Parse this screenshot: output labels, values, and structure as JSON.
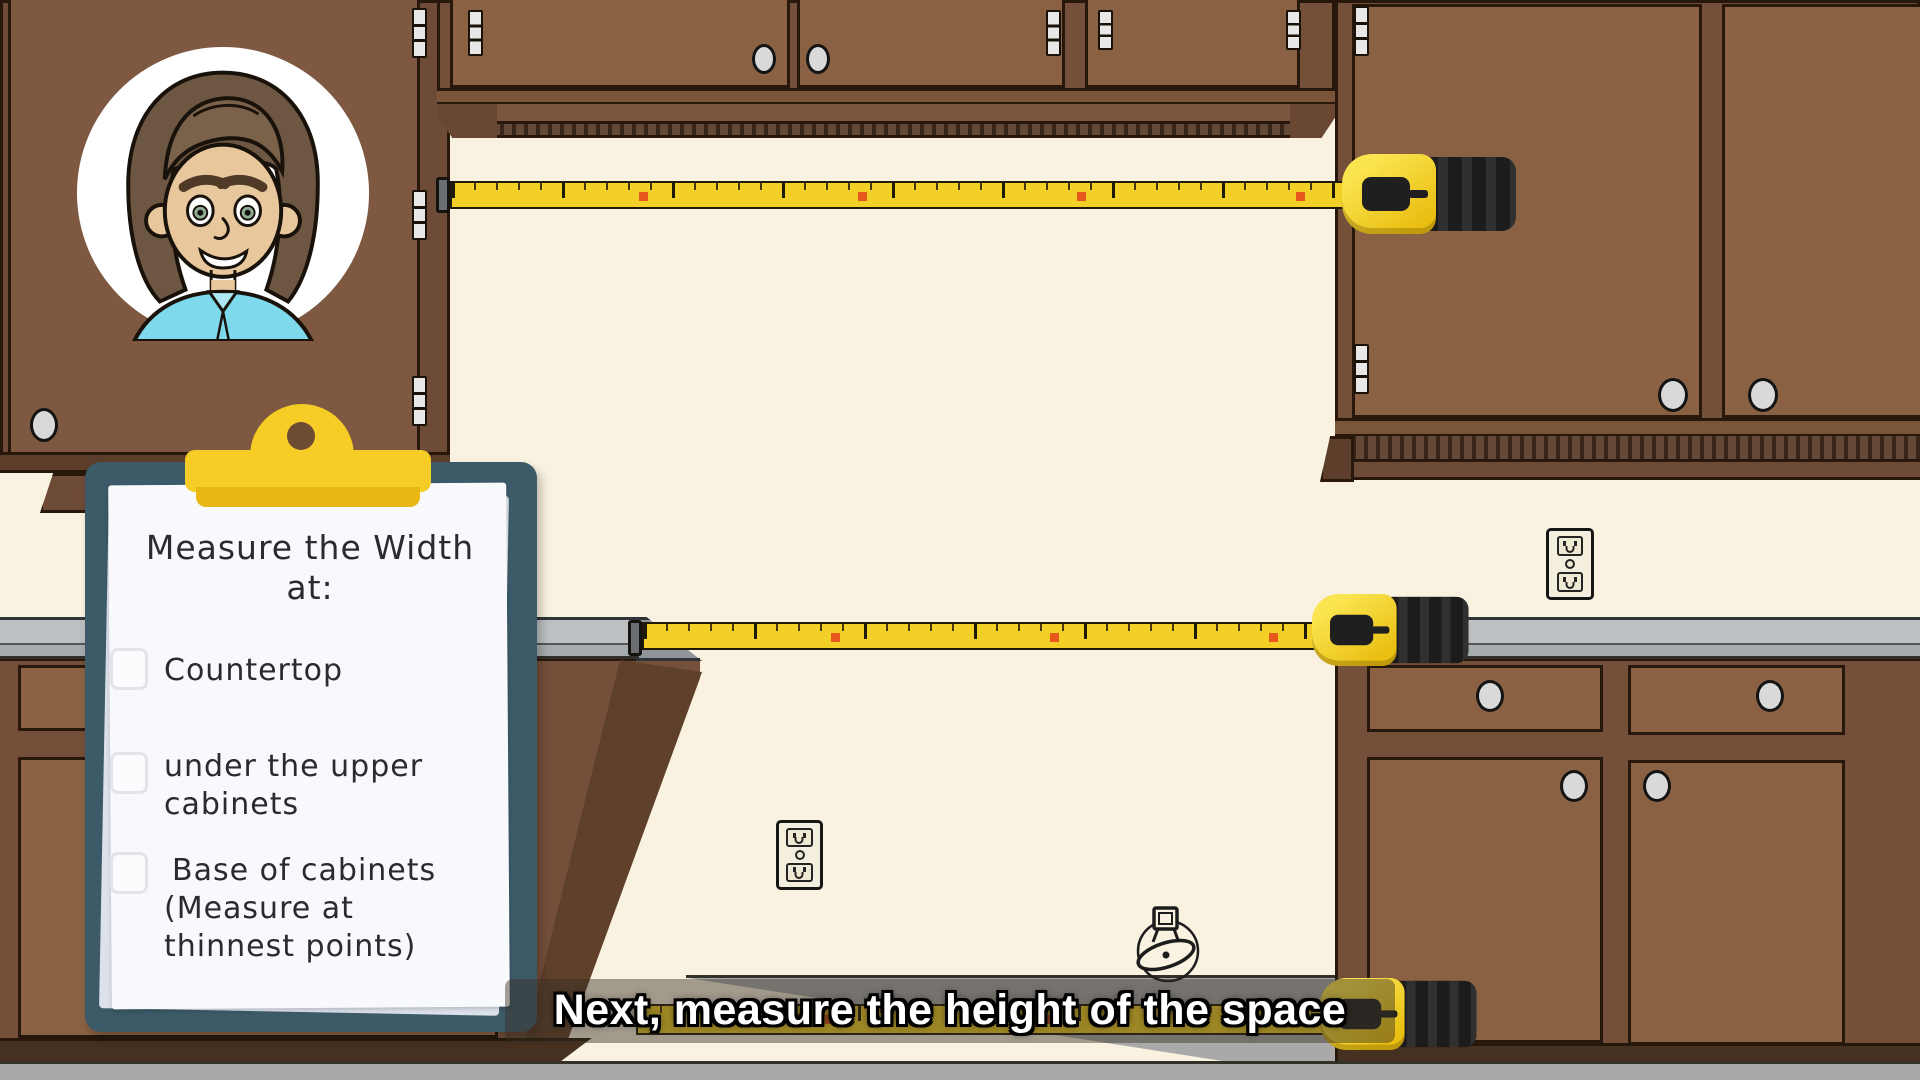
{
  "caption": {
    "text": "Next, measure the height of the space"
  },
  "clipboard": {
    "title_line1": "Measure the Width",
    "title_line2": "at:",
    "items": [
      {
        "checked": false,
        "lines": [
          "Countertop",
          "",
          ""
        ]
      },
      {
        "checked": false,
        "lines": [
          "under the upper",
          "cabinets",
          ""
        ]
      },
      {
        "checked": false,
        "lines": [
          "Base of cabinets",
          "(Measure at",
          "thinnest points)"
        ]
      }
    ]
  },
  "tapes": {
    "count": 3,
    "scale_max_visible_number": 41,
    "red_marker_numbers": [
      10,
      20,
      30,
      40
    ],
    "positions": [
      "between upper cabinets",
      "between countertops",
      "along floor between base cabinets"
    ]
  },
  "icons": {
    "avatar": "man-avatar-illustration",
    "outlet": "duplex-power-outlet",
    "gas_valve": "gas-valve-line-drawing",
    "clip": "clipboard-clip",
    "tape_case": "tape-measure-case"
  },
  "colors": {
    "wall": "#f9f2e1",
    "cabinet_door": "#8a6243",
    "cabinet_frame": "#74503a",
    "countertop": "#bcc0c3",
    "floor": "#a9a9a9",
    "tape_yellow": "#f2d028",
    "tape_red_marker": "#e8581c",
    "tape_case_black": "#262626",
    "clipboard_board": "#3c5a68",
    "clip_yellow": "#f6cd26",
    "paper": "#f8f9fc",
    "caption_text": "#ffffff",
    "caption_outline": "#000000",
    "shirt_cyan": "#7fd9ec"
  }
}
